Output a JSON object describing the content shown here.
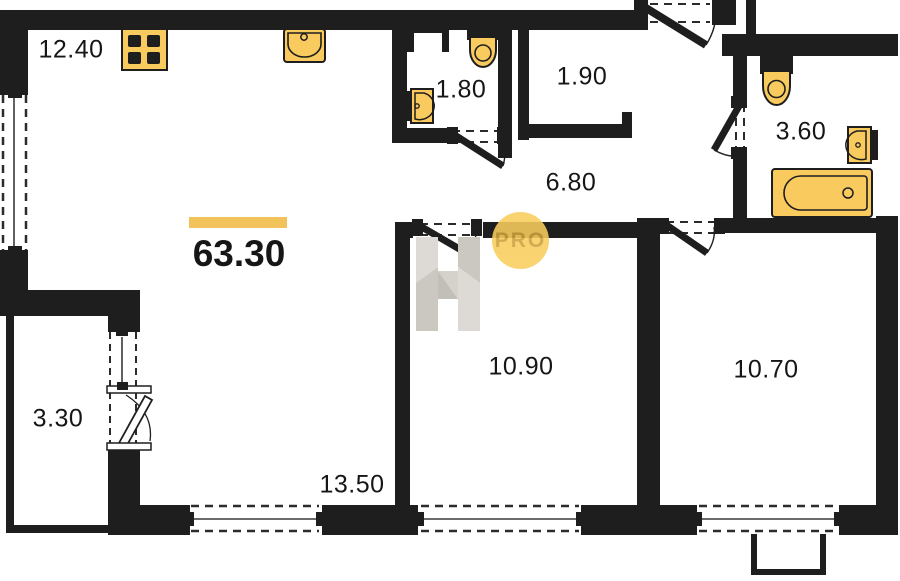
{
  "plan": {
    "total": {
      "area": "63.30"
    },
    "rooms": [
      {
        "id": "kitchen-zone",
        "area": "12.40"
      },
      {
        "id": "wc",
        "area": "1.80"
      },
      {
        "id": "storage",
        "area": "1.90"
      },
      {
        "id": "bathroom",
        "area": "3.60"
      },
      {
        "id": "hallway",
        "area": "6.80"
      },
      {
        "id": "balcony",
        "area": "3.30"
      },
      {
        "id": "living-zone",
        "area": "13.50"
      },
      {
        "id": "bedroom-1",
        "area": "10.90"
      },
      {
        "id": "bedroom-2",
        "area": "10.70"
      }
    ],
    "watermark": {
      "badge": "PRO"
    },
    "fixtures": [
      "stove-icon",
      "kitchen-sink-icon",
      "wc-toilet-icon",
      "wc-sink-icon",
      "bathroom-toilet-icon",
      "bathroom-sink-icon",
      "bathtub-icon"
    ],
    "colors": {
      "accent": "#F8CE5D",
      "wall": "#1E1E1E",
      "badge_text": "#CFA03C",
      "watermark_gray": "#D8D4CE"
    }
  }
}
